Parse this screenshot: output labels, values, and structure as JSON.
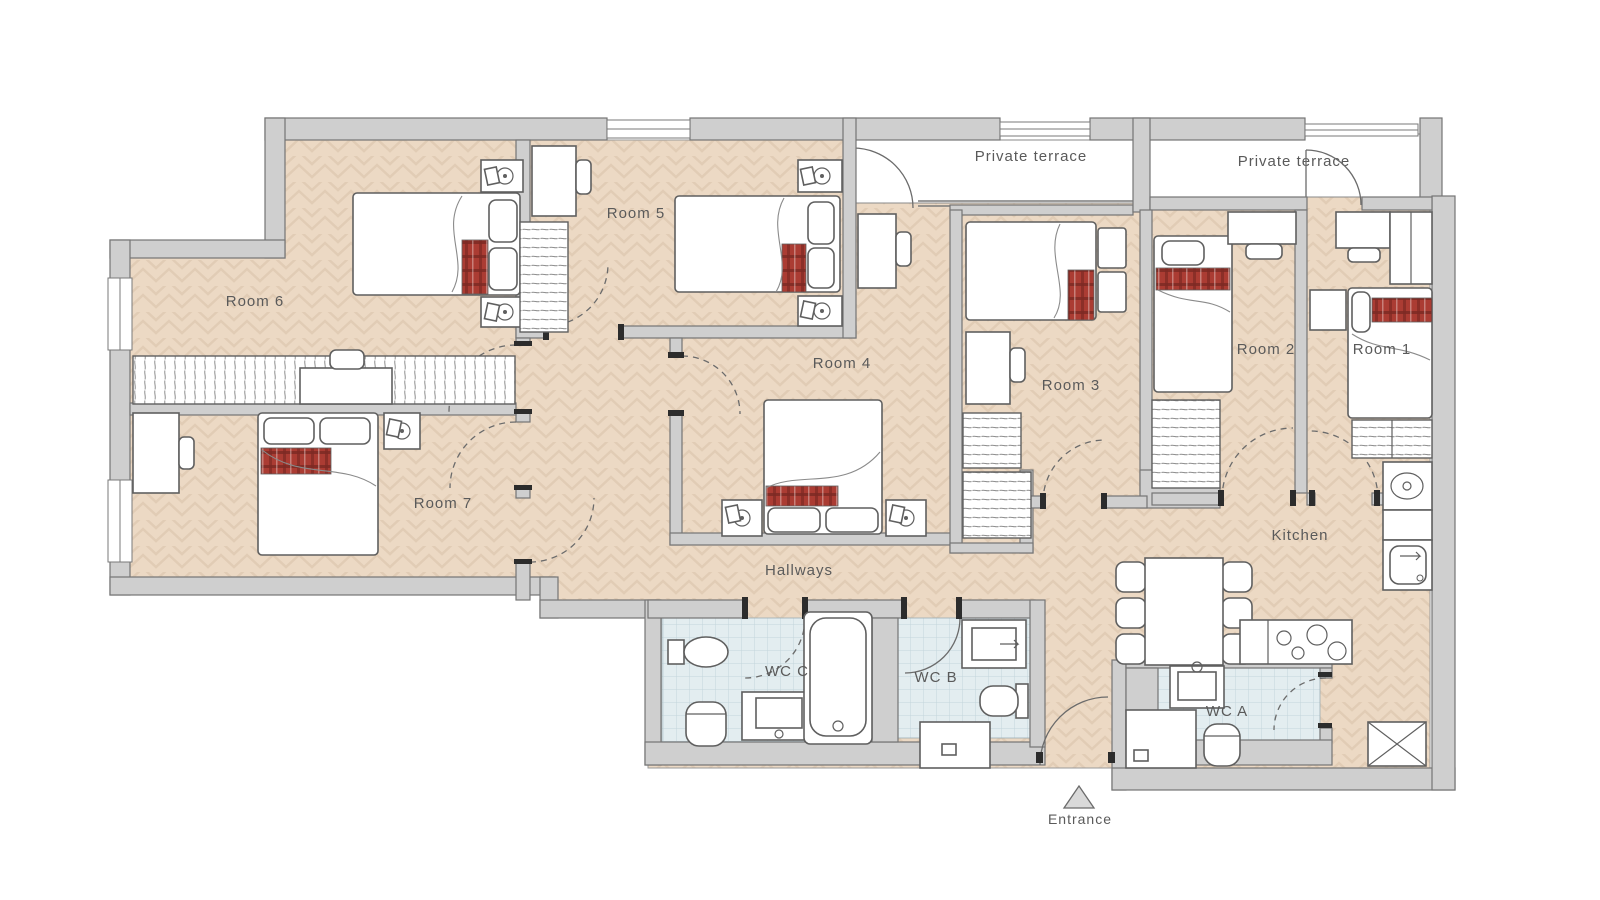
{
  "plan": {
    "labels": {
      "room1": "Room 1",
      "room2": "Room 2",
      "room3": "Room 3",
      "room4": "Room 4",
      "room5": "Room 5",
      "room6": "Room 6",
      "room7": "Room 7",
      "kitchen": "Kitchen",
      "hallways": "Hallways",
      "wc_a": "WC A",
      "wc_b": "WC B",
      "wc_c": "WC C",
      "terrace_left": "Private terrace",
      "terrace_right": "Private terrace",
      "entrance": "Entrance"
    },
    "colors": {
      "floor": "#ecd9c4",
      "floor_line": "#e1ccb5",
      "tile": "#e3edf0",
      "tile_line": "#c3d5db",
      "wall": "#cfcfcf",
      "terrace": "#ffffff",
      "bed_accent": "#ab3c33",
      "bed_accent_dark": "#7e2a23",
      "line": "#5f5f5f",
      "label": "#5a5a5a"
    }
  }
}
